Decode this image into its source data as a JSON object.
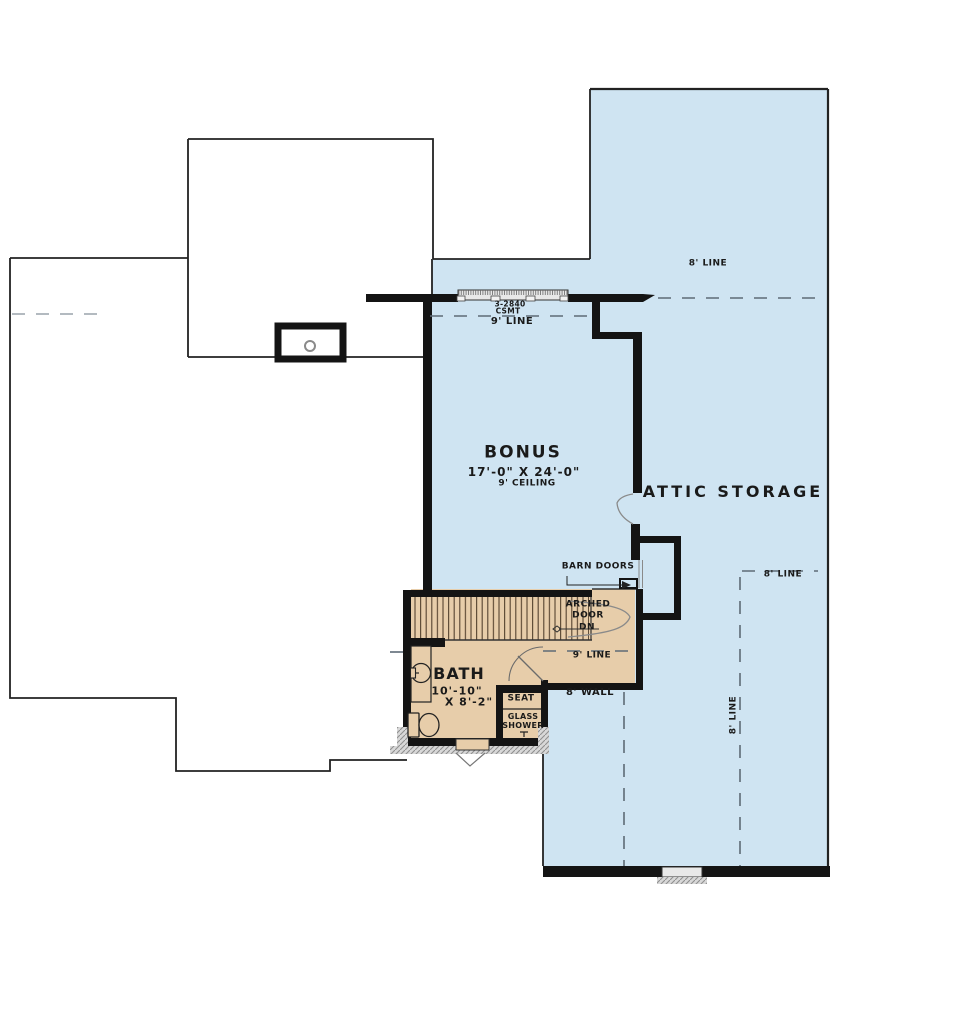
{
  "plan": {
    "rooms": {
      "bonus": {
        "name": "BONUS",
        "dimensions": "17'-0\" X 24'-0\"",
        "ceiling": "9' CEILING"
      },
      "attic": {
        "name": "ATTIC STORAGE"
      },
      "bath": {
        "name": "BATH",
        "width": "10'-10\"",
        "depth": "X 8'-2\""
      }
    },
    "features": {
      "barn_doors": "BARN DOORS",
      "arched_door": [
        "ARCHED",
        "DOOR",
        "DN"
      ],
      "seat": "SEAT",
      "glass_shower": [
        "GLASS",
        "SHOWER"
      ],
      "window_size": "3-2840",
      "window_type": "CSMT"
    },
    "ceiling_lines": {
      "nine_top": "9' LINE",
      "nine_mid": "9' LINE",
      "eight_top": "8' LINE",
      "eight_right": "8' LINE",
      "eight_vertical": "8' LINE",
      "eight_wall": "8' WALL"
    },
    "colors": {
      "attic_fill": "#cfe4f2",
      "room_fill": "#e7cdaa",
      "wall": "#141414"
    }
  }
}
